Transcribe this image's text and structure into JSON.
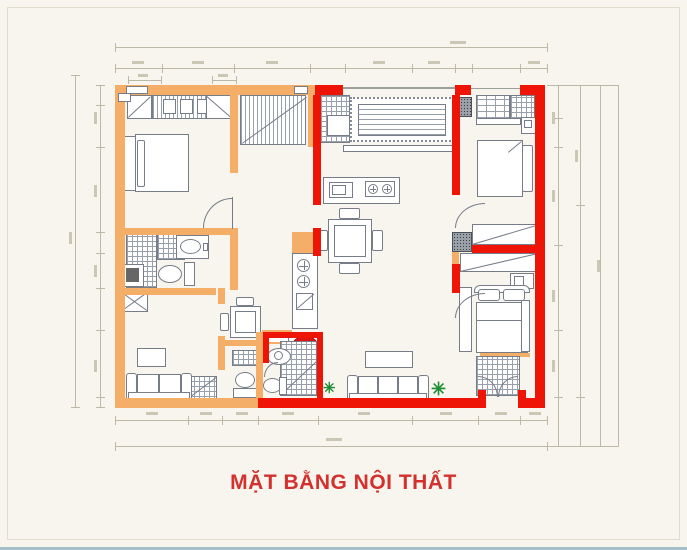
{
  "title": "MẶT BẰNG NỘI THẤT",
  "colors": {
    "background": "#F8F5EE",
    "frame_border": "#E2DDCB",
    "wall_left": "#F5AE67",
    "wall_right": "#EE1507",
    "linework": "#767C88",
    "hatch": "#98A0AC",
    "dimension_line": "#BDB9A7",
    "title_text": "#D2312E",
    "plant": "#1E8C35",
    "basin_accent": "#E01310",
    "page_edge": "#A9BECB"
  },
  "icons": {
    "plant": "✳"
  }
}
